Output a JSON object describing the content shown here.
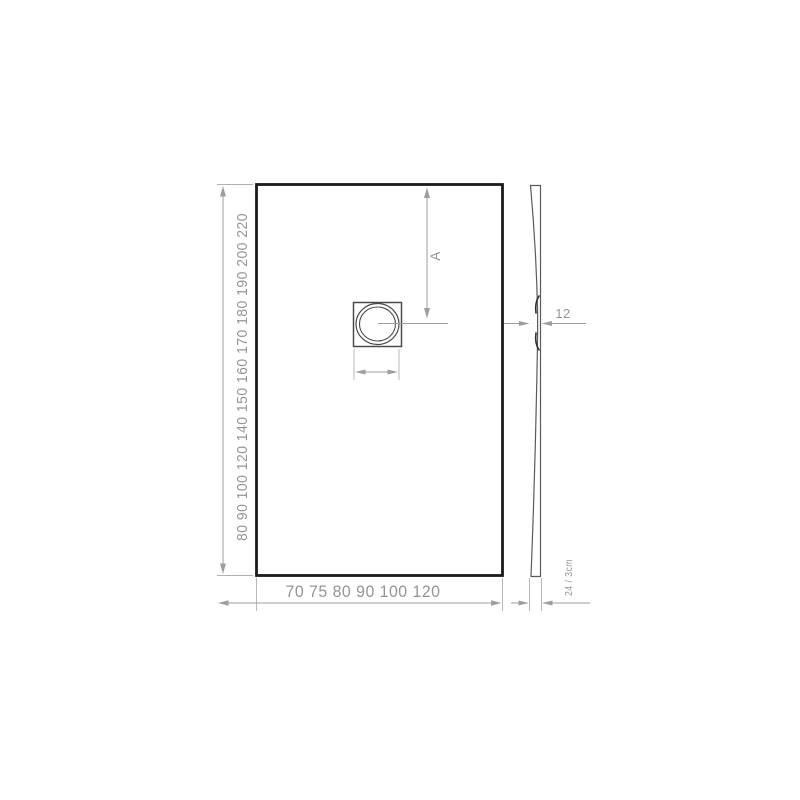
{
  "drawing": {
    "type": "technical-drawing",
    "front_view": {
      "length_scale": "80 90 100 120 140 150 160 170 180 190 200 220",
      "width_scale": "70 75 80 90 100 120",
      "drain_offset_label": "A"
    },
    "side_view": {
      "waist_dimension": "12",
      "thickness_dimension": "24 / 3cm"
    },
    "colors": {
      "background": "#ffffff",
      "outline": "#1c1c1c",
      "detail": "#4a4a4a",
      "dimension_lines": "#9e9e9e",
      "label_text": "#949494"
    }
  }
}
